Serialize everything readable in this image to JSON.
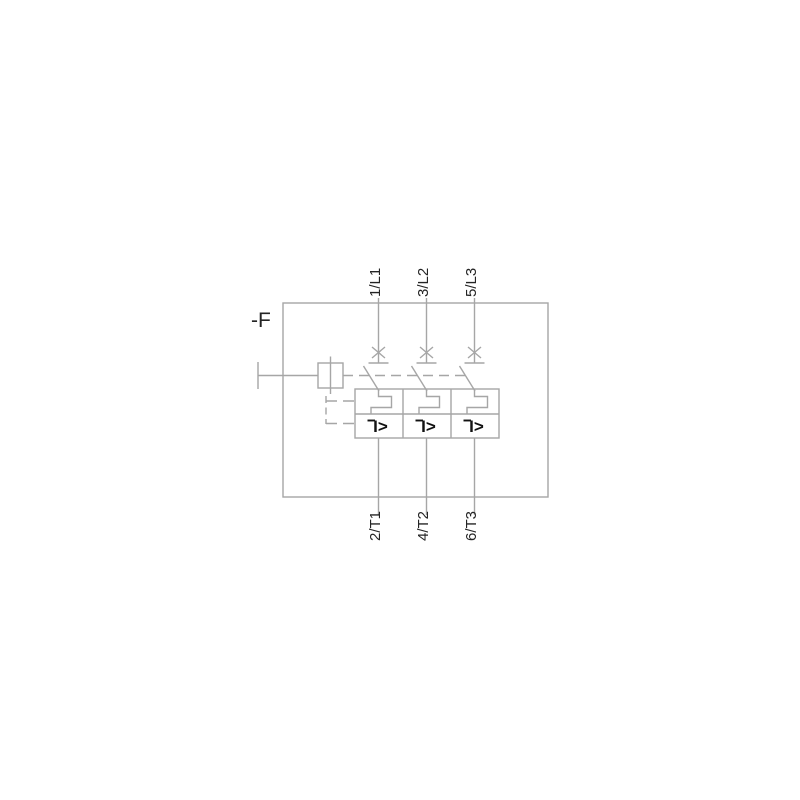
{
  "device_label": "-F",
  "poles": [
    {
      "top_terminal": "1/L1",
      "bottom_terminal": "2/T1"
    },
    {
      "top_terminal": "3/L2",
      "bottom_terminal": "4/T2"
    },
    {
      "top_terminal": "5/L3",
      "bottom_terminal": "6/T3"
    }
  ],
  "overcurrent_symbol": "I>",
  "colors": {
    "line": "#a6a6a6",
    "text": "#242424",
    "symbol": "#111111",
    "background": "#ffffff"
  }
}
